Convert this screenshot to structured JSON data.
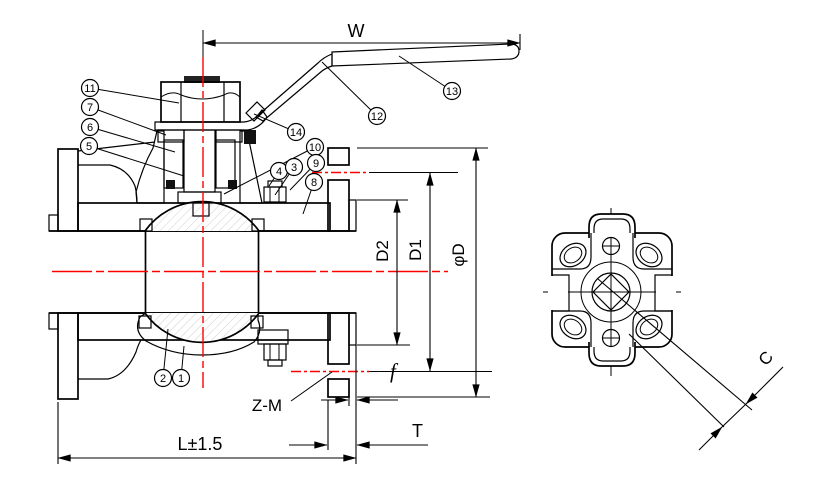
{
  "meta": {
    "background": "#ffffff",
    "line_color": "#000000",
    "centerline_color": "#ff0000",
    "light_hatch_color": "#c4c4c4"
  },
  "dims": {
    "handle_width": "W",
    "raised_face_diameter": "D2",
    "bolt_circle_diameter": "D1",
    "flange_outer_diameter": "φD",
    "raised_face_height": "f",
    "flange_thickness": "T",
    "face_to_face_length": "L±1.5",
    "bolt_holes": "Z-M",
    "corner_chamfer": "C"
  },
  "callouts": [
    {
      "n": "11",
      "cx": 90,
      "cy": 88,
      "tx": 179,
      "ty": 103
    },
    {
      "n": "7",
      "cx": 90,
      "cy": 107,
      "tx": 166,
      "ty": 135
    },
    {
      "n": "6",
      "cx": 90,
      "cy": 127,
      "tx": 175,
      "ty": 152
    },
    {
      "n": "5",
      "cx": 89,
      "cy": 146,
      "tx": 184,
      "ty": 176
    },
    {
      "n": "14",
      "cx": 296,
      "cy": 132,
      "tx": 254,
      "ty": 114
    },
    {
      "n": "12",
      "cx": 377,
      "cy": 116,
      "tx": 322,
      "ty": 62
    },
    {
      "n": "13",
      "cx": 452,
      "cy": 91,
      "tx": 399,
      "ty": 56
    },
    {
      "n": "10",
      "cx": 315,
      "cy": 147,
      "tx": 224,
      "ty": 194
    },
    {
      "n": "4",
      "cx": 279,
      "cy": 171,
      "tx": 269,
      "ty": 186
    },
    {
      "n": "3",
      "cx": 294,
      "cy": 167,
      "tx": 275,
      "ty": 195
    },
    {
      "n": "9",
      "cx": 316,
      "cy": 163,
      "tx": 290,
      "ty": 190
    },
    {
      "n": "8",
      "cx": 314,
      "cy": 182,
      "tx": 303,
      "ty": 214
    },
    {
      "n": "2",
      "cx": 163,
      "cy": 378,
      "tx": 168,
      "ty": 329
    },
    {
      "n": "1",
      "cx": 181,
      "cy": 378,
      "tx": 184,
      "ty": 346
    }
  ]
}
